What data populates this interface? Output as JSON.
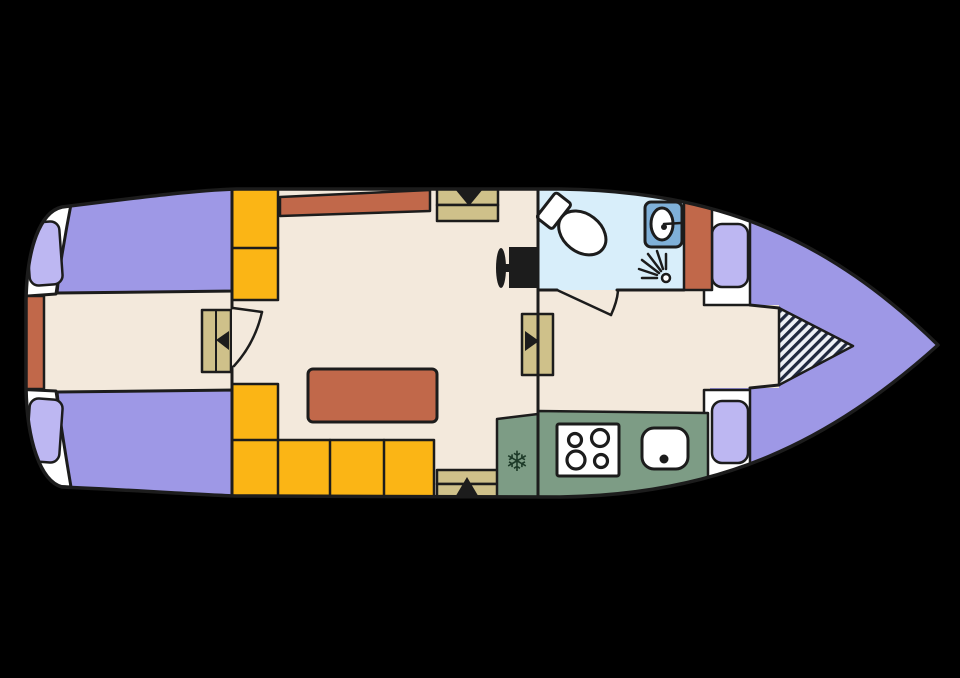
{
  "meta": {
    "description": "Top-view interior deck plan of a motor yacht, bow pointing right, on black background",
    "diagram_type": "boat-floor-plan"
  },
  "palette": {
    "bg": "#000000",
    "outline": "#1c1c1c",
    "hull": "#ffffff",
    "floor": "#f3e9dc",
    "bed": "#9e98e6",
    "cushion": "#bdb7f2",
    "wood": "#cfc18a",
    "terracotta": "#c1684a",
    "bench": "#fbb515",
    "galley": "#7d9c85",
    "bath": "#d8eefa",
    "sinkblue": "#7fb0d8",
    "appliance": "#ffffff",
    "hatch_bg": "#eef1f6",
    "hatch_line": "#20293f",
    "snowflake": "#1d3a28"
  },
  "rooms": {
    "aft_cabin": {
      "berths": 2,
      "pillows": 2,
      "features": [
        "stern-platform",
        "cabin-steps",
        "door-to-salon"
      ]
    },
    "salon": {
      "features": [
        "storage-cabinets",
        "sideboard-counter",
        "companionway-steps-up",
        "dinette-table",
        "l-shaped-bench",
        "companionway-steps-down",
        "helm-seat"
      ]
    },
    "head": {
      "features": [
        "toilet",
        "washbasin",
        "shower",
        "storage-cabinet",
        "door"
      ]
    },
    "galley": {
      "freezer_icon": "❄",
      "stove_burners": 4,
      "features": [
        "freezer",
        "stove",
        "sink"
      ]
    },
    "corridor": {
      "features": [
        "steps-to-bow",
        "walkway"
      ]
    },
    "bow_cabin": {
      "berths": 1,
      "cushions": 2,
      "features": [
        "v-berth",
        "seat-cushions",
        "hatched-walkway-infill"
      ]
    }
  }
}
